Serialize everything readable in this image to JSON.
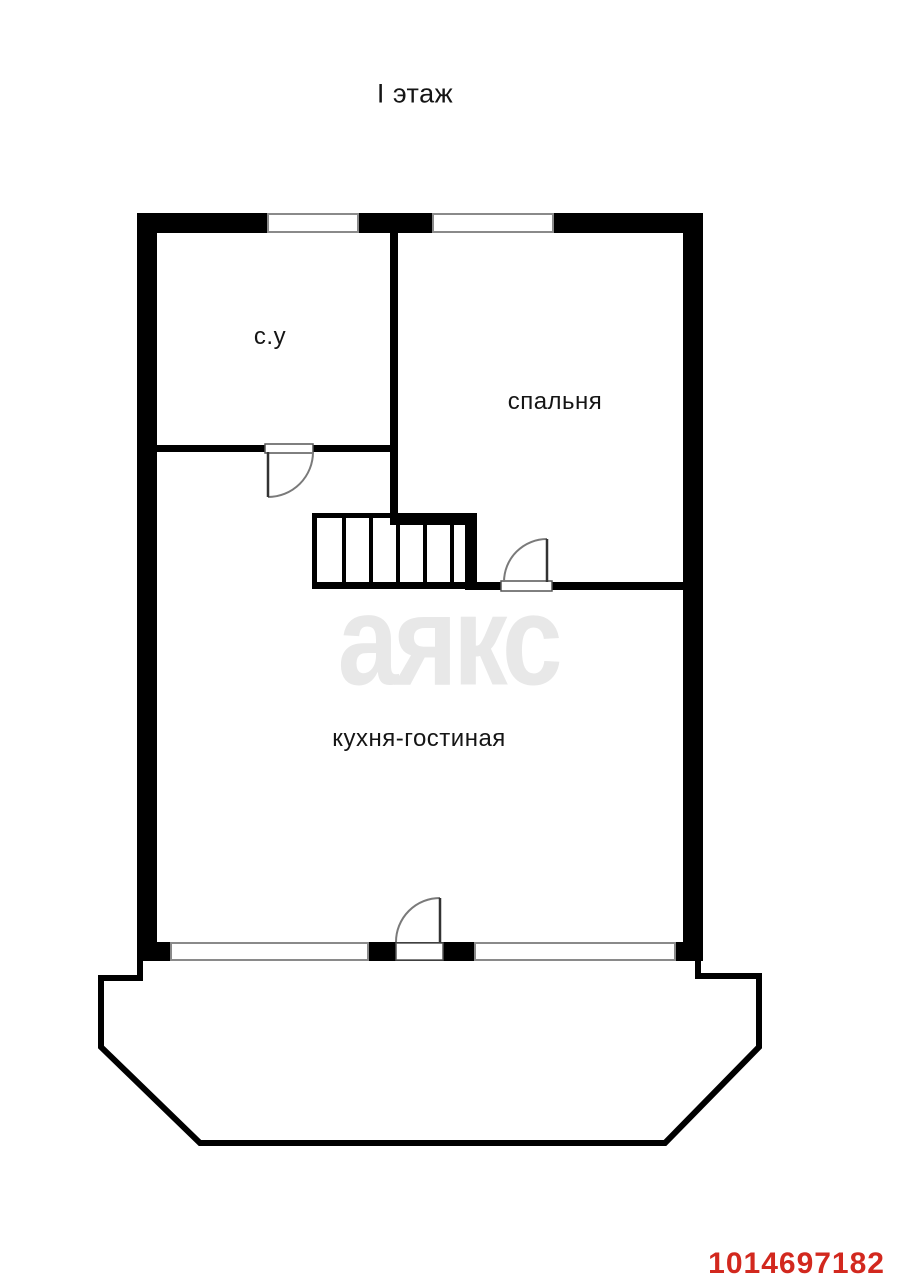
{
  "page": {
    "title": "I этаж",
    "background": "#ffffff"
  },
  "rooms": {
    "bathroom": {
      "label": "с.у"
    },
    "bedroom": {
      "label": "спальня"
    },
    "kitchen_living": {
      "label": "кухня-гостиная"
    }
  },
  "watermark": {
    "text": "аякс",
    "color": "#e8e8e8"
  },
  "listing": {
    "id": "1014697182",
    "color": "#d2281e"
  },
  "colors": {
    "wall": "#000000",
    "window_outline": "#8a8a8a",
    "threshold_outline": "#555555",
    "door_leaf": "#333333",
    "door_arc": "#7a7a7a",
    "terrace_outline": "#000000"
  }
}
